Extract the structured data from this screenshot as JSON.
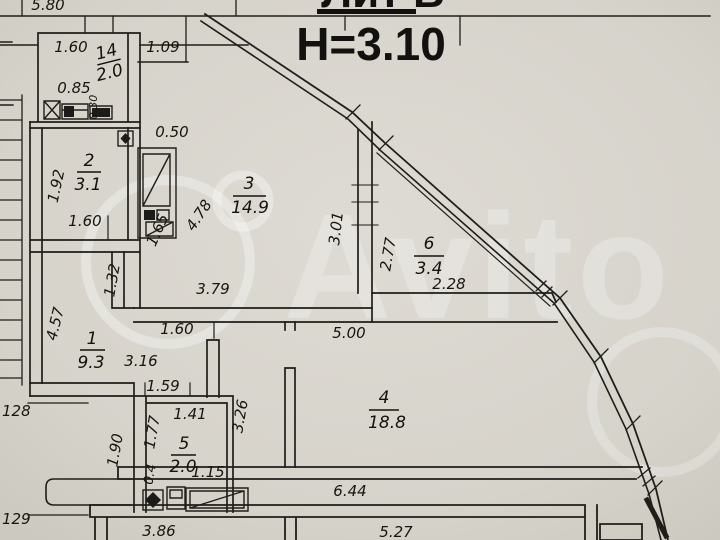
{
  "title": {
    "building_label": "Лит В",
    "ceiling_height": "Н=3.10"
  },
  "watermark": {
    "brand": "Avito"
  },
  "rooms": {
    "storage14": {
      "number": "14",
      "area": "2.0"
    },
    "room2": {
      "number": "2",
      "area": "3.1"
    },
    "room3": {
      "number": "3",
      "area": "14.9"
    },
    "room6": {
      "number": "6",
      "area": "3.4"
    },
    "room1": {
      "number": "1",
      "area": "9.3"
    },
    "room5": {
      "number": "5",
      "area": "2.0"
    },
    "room4": {
      "number": "4",
      "area": "18.8"
    }
  },
  "dimensions": {
    "top_580": "5.80",
    "top_160": "1.60",
    "top_109": "1.09",
    "wc_085": "0.85",
    "wc_030": "0.30",
    "r2_192": "1.92",
    "r2_160": "1.60",
    "r3_050": "0.50",
    "r3_478": "4.78",
    "r3_165": "1.65",
    "r3_379": "3.79",
    "r3_301": "3.01",
    "mid_160": "1.60",
    "mid_500": "5.00",
    "r6_277": "2.77",
    "r6_228": "2.28",
    "r1_457": "4.57",
    "r1_132": "1.32",
    "r1_316": "3.16",
    "r1_159": "1.59",
    "r5_141": "1.41",
    "r5_177": "1.77",
    "r5_04": "0.4",
    "r5_115": "1.15",
    "r5_326": "3.26",
    "r5_190": "1.90",
    "r4_644": "6.44",
    "bottom_386": "3.86",
    "bottom_527": "5.27",
    "level_128": "128",
    "level_129": "129"
  },
  "colors": {
    "paper": "#d8d5ce",
    "ink": "#1f1d19",
    "watermark": "#ffffff"
  }
}
